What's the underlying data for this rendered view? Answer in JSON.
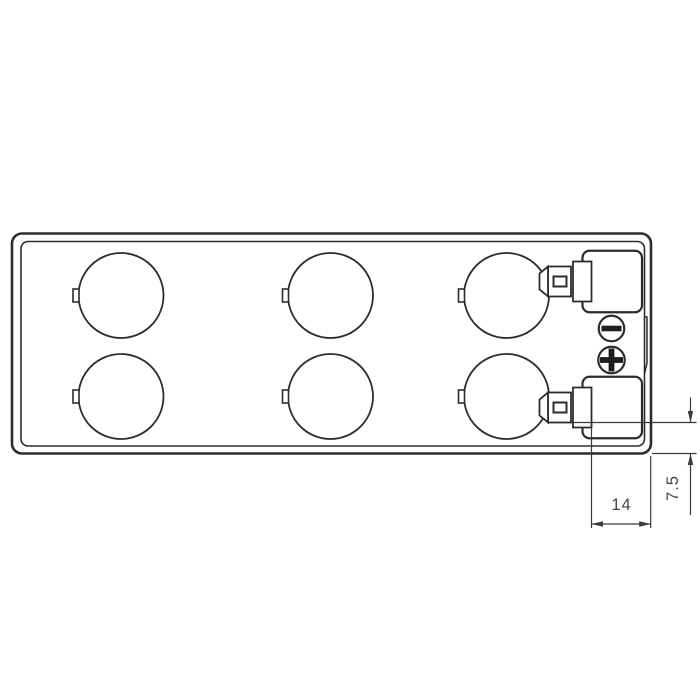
{
  "title": "Battery top view technical drawing",
  "drawing": {
    "view": "top-view-outline",
    "cells": {
      "rows": 2,
      "columns": 3,
      "count": 6
    },
    "terminals": {
      "type": "faston-tab",
      "negative_symbol": "−",
      "positive_symbol": "+"
    },
    "dimensions": {
      "width_14": {
        "label": "14",
        "orientation": "horizontal"
      },
      "height_7_5": {
        "label": "7.5",
        "orientation": "vertical"
      }
    },
    "colors": {
      "background": "#ffffff",
      "outline": "#2d2d2d",
      "dimension_lines": "#3a3a3a",
      "dimension_text": "#454545",
      "symbol_fill": "#1e1e1e"
    }
  }
}
